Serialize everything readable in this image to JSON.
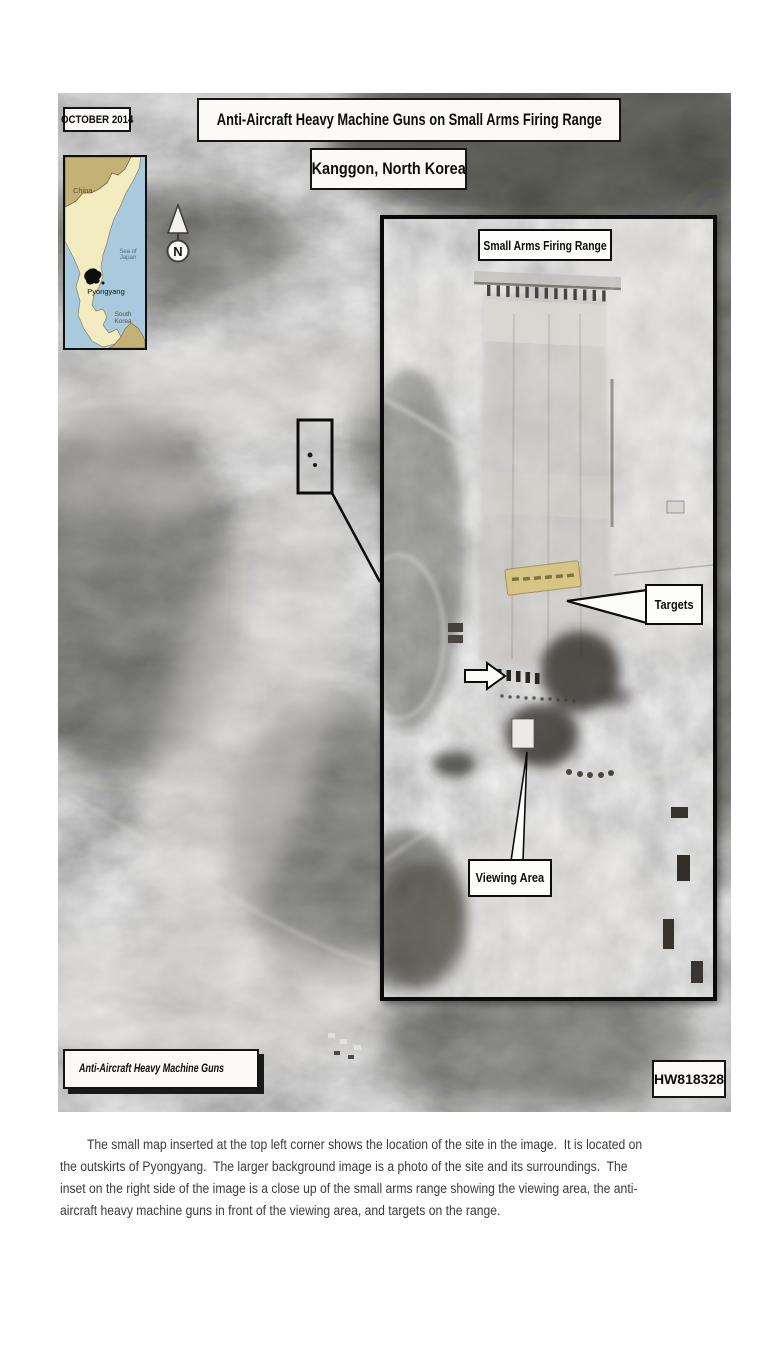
{
  "page": {
    "date_label": "OCTOBER 2014",
    "title": "Anti-Aircraft Heavy Machine Guns on Small Arms Firing Range",
    "subtitle": "Kanggon, North Korea",
    "image_id": "HW818328"
  },
  "locator_map": {
    "china_label": "China",
    "sea_label": "Sea of Japan",
    "capital_label": "Pyongyang",
    "south_korea_label": "South Korea",
    "colors": {
      "sea": "#a9c9dd",
      "north_korea": "#f2ecc0",
      "neighbors": "#c4b176"
    }
  },
  "compass": {
    "north_label": "N"
  },
  "inset": {
    "range_label": "Small Arms Firing Range",
    "targets_label": "Targets",
    "viewing_area_label": "Viewing Area",
    "target_highlight_color": "#d8c478"
  },
  "legend": {
    "label": "Anti-Aircraft Heavy Machine Guns"
  },
  "caption": {
    "lines": [
      "The small map inserted at the top left corner shows the location of the site in the image.  It is located on",
      "the outskirts of Pyongyang.  The larger background image is a photo of the site and its surroundings.  The",
      "inset on the right side of the image is a close up of the small arms range showing the viewing area, the anti-",
      "aircraft heavy machine guns in front of the viewing area, and targets on the range."
    ]
  }
}
